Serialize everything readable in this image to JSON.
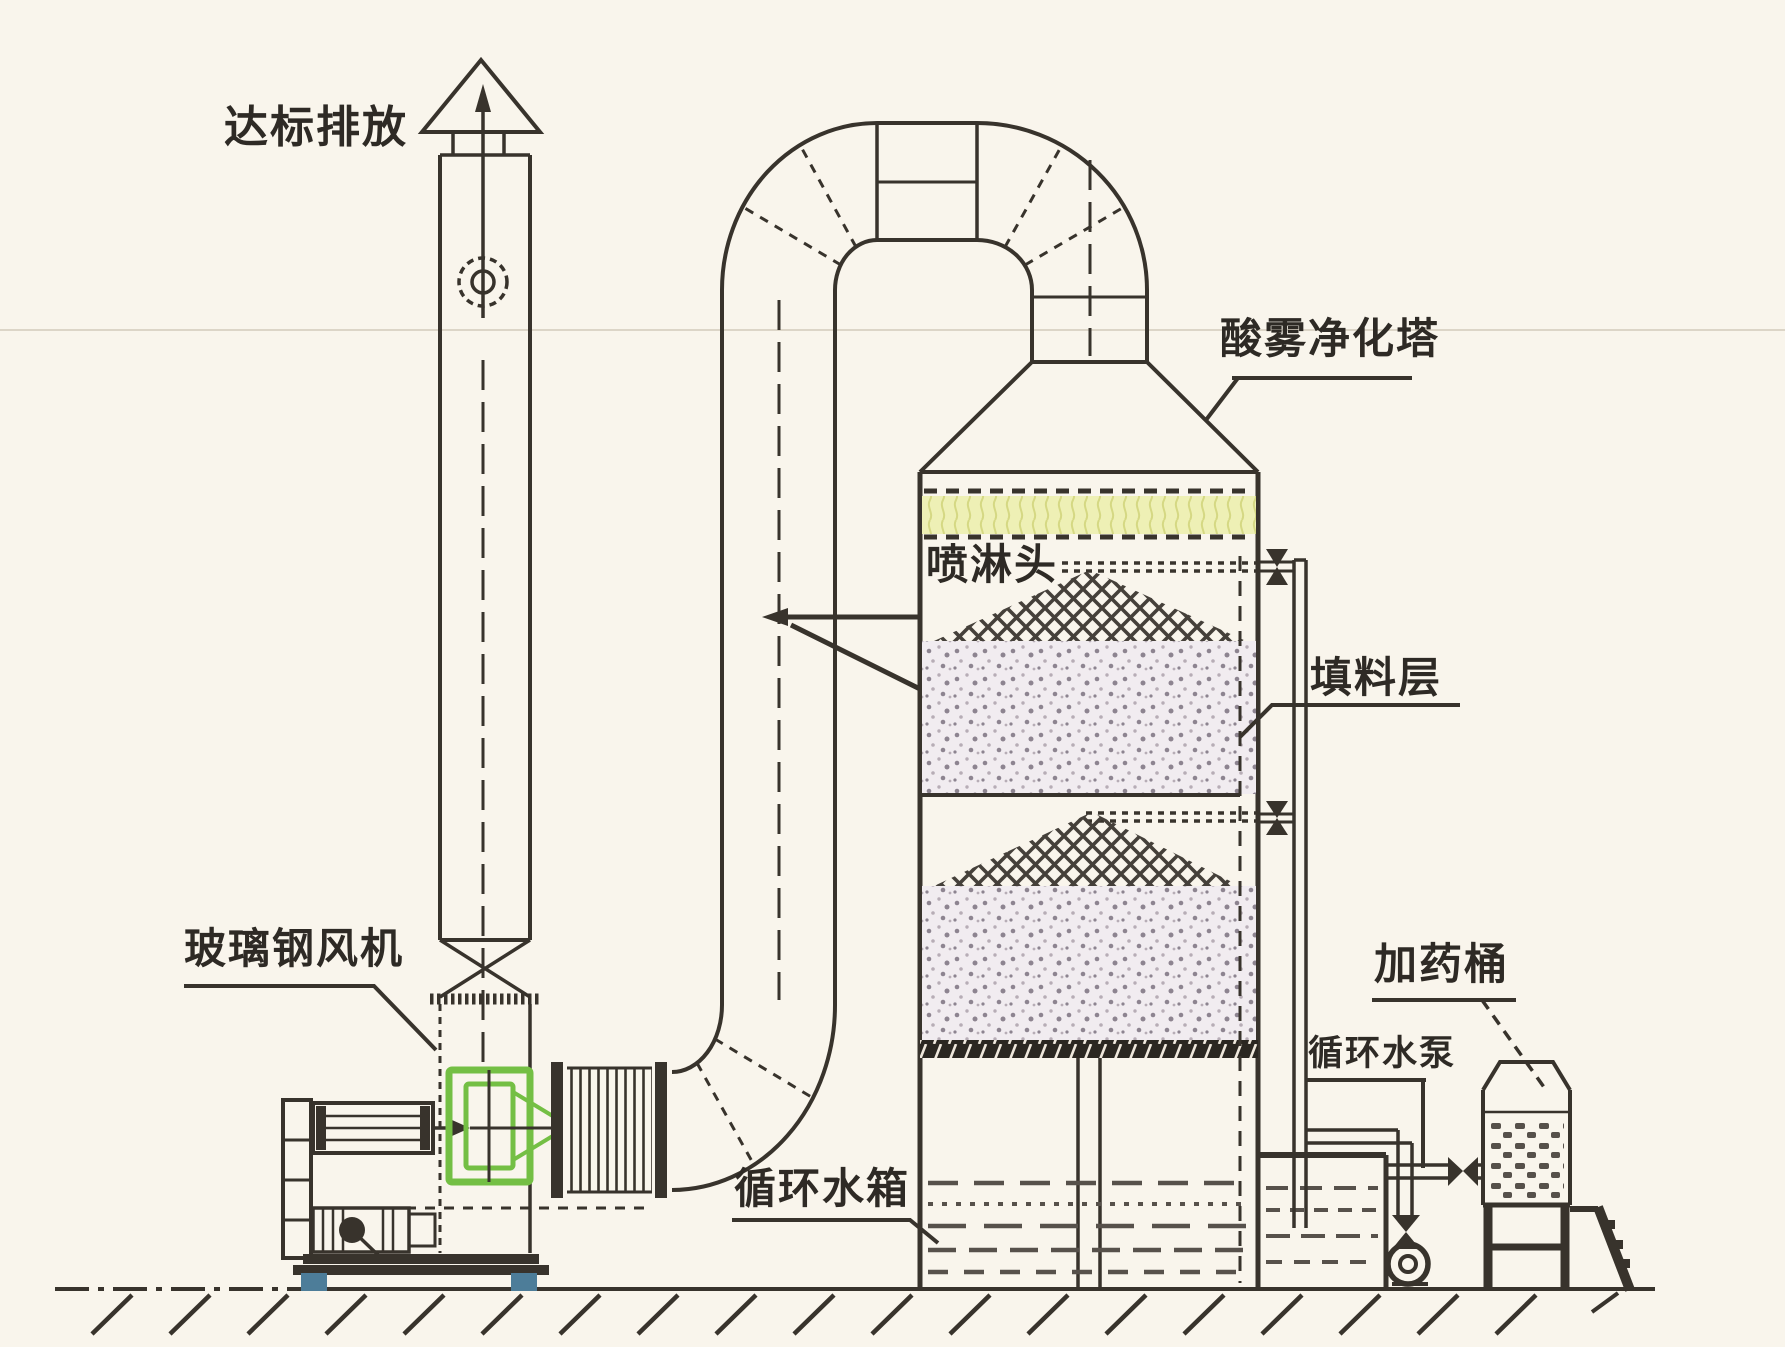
{
  "labels": {
    "discharge": "达标排放",
    "fan": "玻璃钢风机",
    "tower": "酸雾净化塔",
    "spray_head": "喷淋头",
    "packing_layer": "填料层",
    "water_tank": "循环水箱",
    "water_pump": "循环水泵",
    "dosing_barrel": "加药桶"
  },
  "colors": {
    "background": "#f9f5ec",
    "line": "#38332c",
    "demister_yellow": "#eef0b5",
    "demister_stroke": "#d5d883",
    "packing_fill": "#f1ecf0",
    "packing_dot": "#8d8490",
    "spray_hatch": "#45403a",
    "fan_green": "#74bf44",
    "foot_blue": "#4d7d99",
    "support_band": "#2b2721",
    "water": "#57514b"
  }
}
